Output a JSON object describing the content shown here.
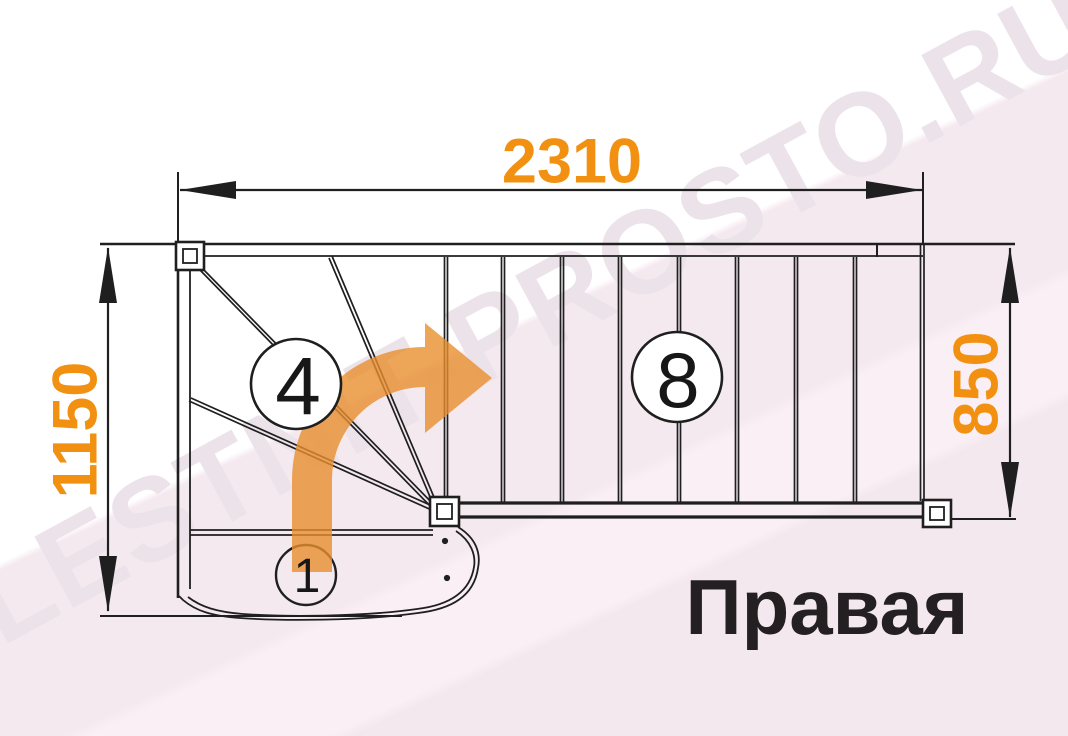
{
  "diagram": {
    "caption": "Правая",
    "watermark": "LESTNIT-PROSTO.RU",
    "dimensions": {
      "top_width": "2310",
      "left_depth": "1150",
      "right_width": "850"
    },
    "step_counts": {
      "winder_section": "4",
      "straight_flight": "8",
      "first_step": "1"
    },
    "colors": {
      "dimension_text": "#f29111",
      "turn_arrow": "#e98f2e",
      "drawing_line": "#1f1f1f",
      "caption_text": "#241f21",
      "background_tint": "#f5e9f0",
      "watermark_gray": "#ece3ea"
    }
  }
}
